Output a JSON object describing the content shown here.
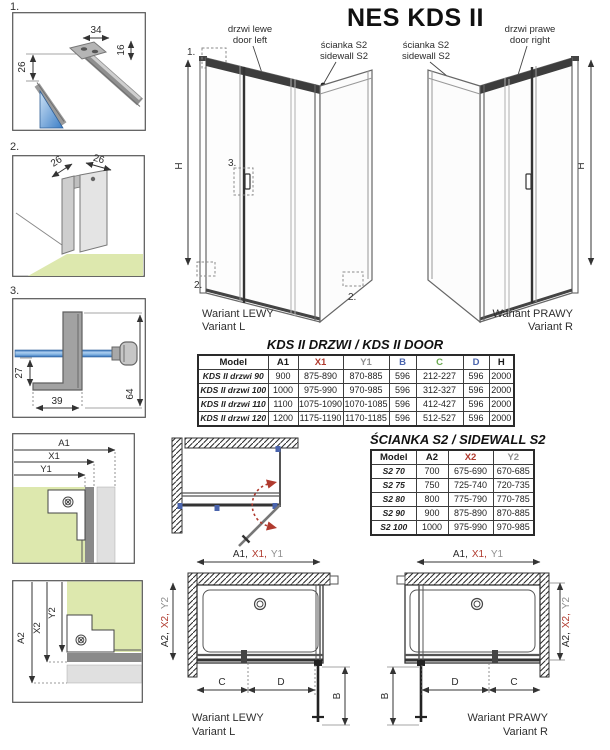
{
  "title": "NES KDS II",
  "details": {
    "d1": {
      "num": "1.",
      "w": "34",
      "t": "16",
      "h": "26"
    },
    "d2": {
      "num": "2.",
      "left": "26",
      "right": "26"
    },
    "d3": {
      "num": "3.",
      "inner": "27",
      "foot": "39",
      "total": "64"
    }
  },
  "variant_left": {
    "door_line1": "drzwi lewe",
    "door_line2": "door left",
    "side_line1": "ścianka S2",
    "side_line2": "sidewall S2",
    "h": "H",
    "c1": "1.",
    "c2a": "2.",
    "c2b": "2.",
    "c3": "3.",
    "caption1": "Wariant LEWY",
    "caption2": "Variant L"
  },
  "variant_right": {
    "side_line1": "ścianka S2",
    "side_line2": "sidewall S2",
    "door_line1": "drzwi prawe",
    "door_line2": "door right",
    "h": "H",
    "caption1": "Wariant PRAWY",
    "caption2": "Variant R"
  },
  "door_table": {
    "title": "KDS II DRZWI / KDS II DOOR",
    "headers": [
      {
        "label": "Model",
        "color": "black"
      },
      {
        "label": "A1",
        "color": "black"
      },
      {
        "label": "X1",
        "color": "red"
      },
      {
        "label": "Y1",
        "color": "gray"
      },
      {
        "label": "B",
        "color": "blue"
      },
      {
        "label": "C",
        "color": "green"
      },
      {
        "label": "D",
        "color": "blue"
      },
      {
        "label": "H",
        "color": "black"
      }
    ],
    "rows": [
      [
        "KDS II drzwi 90",
        "900",
        "875-890",
        "870-885",
        "596",
        "212-227",
        "596",
        "2000"
      ],
      [
        "KDS II drzwi 100",
        "1000",
        "975-990",
        "970-985",
        "596",
        "312-327",
        "596",
        "2000"
      ],
      [
        "KDS II drzwi 110",
        "1100",
        "1075-1090",
        "1070-1085",
        "596",
        "412-427",
        "596",
        "2000"
      ],
      [
        "KDS II drzwi 120",
        "1200",
        "1175-1190",
        "1170-1185",
        "596",
        "512-527",
        "596",
        "2000"
      ]
    ]
  },
  "sidewall_table": {
    "title": "ŚCIANKA S2 / SIDEWALL S2",
    "headers": [
      {
        "label": "Model",
        "color": "black"
      },
      {
        "label": "A2",
        "color": "black"
      },
      {
        "label": "X2",
        "color": "red"
      },
      {
        "label": "Y2",
        "color": "gray"
      }
    ],
    "rows": [
      [
        "S2 70",
        "700",
        "675-690",
        "670-685"
      ],
      [
        "S2 75",
        "750",
        "725-740",
        "720-735"
      ],
      [
        "S2 80",
        "800",
        "775-790",
        "770-785"
      ],
      [
        "S2 90",
        "900",
        "875-890",
        "870-885"
      ],
      [
        "S2 100",
        "1000",
        "975-990",
        "970-985"
      ]
    ]
  },
  "dims": {
    "a1": "A1",
    "x1": "X1",
    "y1": "Y1",
    "a2": "A2",
    "x2": "X2",
    "y2": "Y2",
    "a1c": "A1,",
    "x1c": "X1,",
    "a2c": "A2,",
    "x2c": "X2,",
    "b": "B",
    "c": "C",
    "d": "D"
  },
  "plan_left": {
    "caption1": "Wariant LEWY",
    "caption2": "Variant L"
  },
  "plan_right": {
    "caption1": "Wariant PRAWY",
    "caption2": "Variant R"
  },
  "colors": {
    "red": "#b03a2e",
    "gray": "#8f8f8f",
    "blue": "#4a64ad",
    "green": "#69a84f",
    "floor": "#dde8ae",
    "glass_dark": "#2f6db6",
    "glass_light": "#aecff0"
  }
}
